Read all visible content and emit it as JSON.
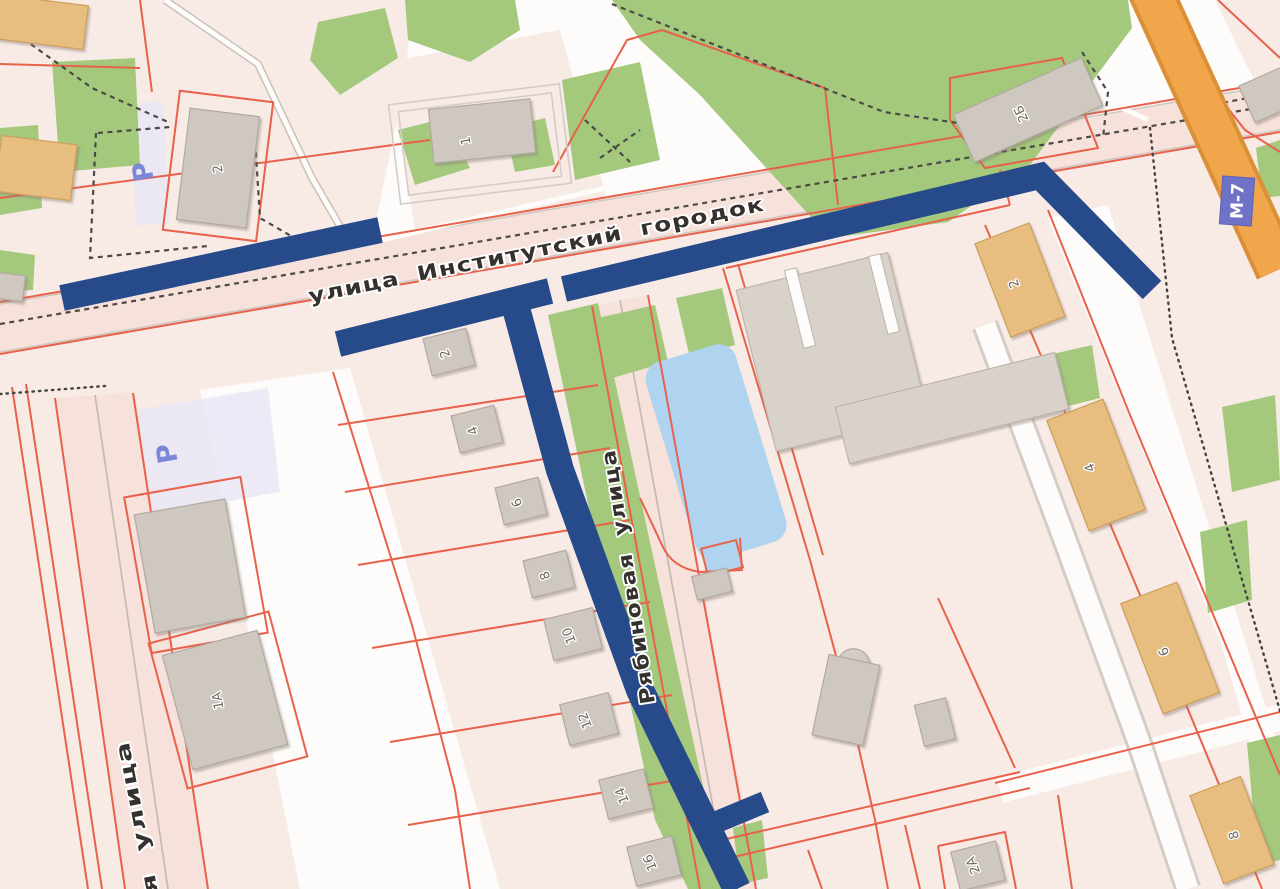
{
  "map": {
    "street_labels": {
      "main": "улица Институтский городок",
      "side": "Рябиновая улица",
      "left_partial": "я улица"
    },
    "highway": {
      "badge": "М-7"
    },
    "parking": {
      "symbol": "Р"
    },
    "housenumbers": [
      {
        "label": "2"
      },
      {
        "label": "1"
      },
      {
        "label": "2Б"
      },
      {
        "label": "2"
      },
      {
        "label": "4"
      },
      {
        "label": "6"
      },
      {
        "label": "8"
      },
      {
        "label": "10"
      },
      {
        "label": "12"
      },
      {
        "label": "14"
      },
      {
        "label": "16"
      },
      {
        "label": "1А"
      },
      {
        "label": "2"
      },
      {
        "label": "4"
      },
      {
        "label": "6"
      },
      {
        "label": "8"
      },
      {
        "label": "2А"
      }
    ],
    "colors": {
      "route": "#274a8a",
      "parcel_line": "#e8614a",
      "parcel_fill": "#f8ebe6",
      "water": "#b0d4f0",
      "green": "#a4c97d",
      "highway_fill": "#f2a64c",
      "highway_casing": "#da9036",
      "badge_fill": "#6e73c7",
      "building": "#cfc8c0",
      "building_tan": "#e7bd80"
    }
  }
}
